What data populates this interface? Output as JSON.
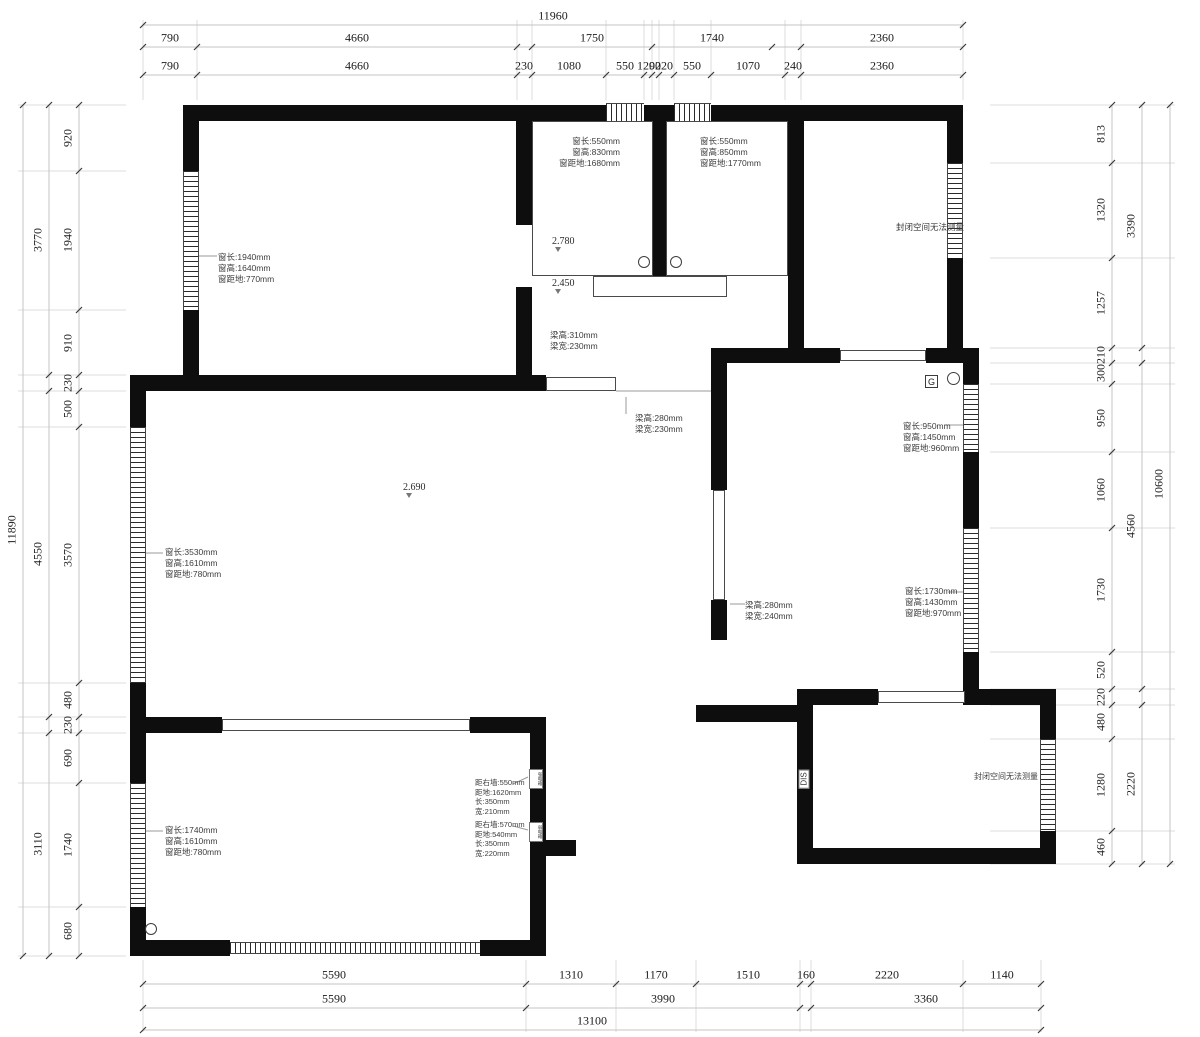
{
  "dims": {
    "top": {
      "total": [
        "11960"
      ],
      "row2": [
        "790",
        "4660",
        "1750",
        "1740",
        "2360"
      ],
      "row3": [
        "790",
        "4660",
        "230",
        "1080",
        "550",
        "120",
        "90",
        "220",
        "550",
        "1070",
        "240",
        "2360"
      ]
    },
    "bottom": {
      "row1": [
        "5590",
        "1310",
        "1170",
        "1510",
        "160",
        "2220",
        "1140"
      ],
      "row2": [
        "5590",
        "3990",
        "3360"
      ],
      "total": [
        "13100"
      ]
    },
    "left": {
      "inner": [
        "920",
        "1940",
        "910",
        "230",
        "500",
        "3570",
        "480",
        "230",
        "690",
        "1740",
        "680"
      ],
      "mid": [
        "3770",
        "4550",
        "3110"
      ],
      "total": [
        "11890"
      ]
    },
    "right": {
      "inner": [
        "813",
        "1320",
        "1257",
        "210",
        "300",
        "950",
        "1060",
        "1730",
        "520",
        "220",
        "480",
        "1280",
        "460"
      ],
      "mid": [
        "3390",
        "4560",
        "2220"
      ],
      "total": [
        "10600"
      ]
    }
  },
  "annotations": {
    "window_top_left_room": {
      "lines": [
        "窗长:1940mm",
        "窗高:1640mm",
        "窗距地:770mm"
      ]
    },
    "window_bath1": {
      "lines": [
        "窗长:550mm",
        "窗高:830mm",
        "窗距地:1680mm"
      ]
    },
    "window_bath2": {
      "lines": [
        "窗长:550mm",
        "窗高:850mm",
        "窗距地:1770mm"
      ]
    },
    "window_right_upper": {
      "lines": [
        "窗长:950mm",
        "窗高:1450mm",
        "窗距地:960mm"
      ]
    },
    "window_right_lower": {
      "lines": [
        "窗长:1730mm",
        "窗高:1430mm",
        "窗距地:970mm"
      ]
    },
    "window_living": {
      "lines": [
        "窗长:3530mm",
        "窗高:1610mm",
        "窗距地:780mm"
      ]
    },
    "window_bottom_left_room": {
      "lines": [
        "窗长:1740mm",
        "窗高:1610mm",
        "窗距地:780mm"
      ]
    },
    "beam1": {
      "lines": [
        "梁高:310mm",
        "梁宽:230mm"
      ]
    },
    "beam2": {
      "lines": [
        "梁高:280mm",
        "梁宽:230mm"
      ]
    },
    "beam3": {
      "lines": [
        "梁高:280mm",
        "梁宽:240mm"
      ]
    },
    "elec_box_high": {
      "lines": [
        "距右墙:550mm",
        "距地:1620mm",
        "长:350mm",
        "宽:210mm"
      ]
    },
    "elec_box_low": {
      "lines": [
        "距右墙:570mm",
        "距地:540mm",
        "长:350mm",
        "宽:220mm"
      ]
    },
    "elec_box_high_tag": "强电箱",
    "elec_box_low_tag": "弱电箱",
    "elevation_bath1_a": "2.780",
    "elevation_bath1_b": "2.450",
    "elevation_living": "2.690",
    "closed_space_top": "封闭空间无法测量",
    "closed_space_bottom": "封闭空间无法测量",
    "marker_g": "G",
    "marker_dis": "DIS"
  },
  "colors": {
    "wall": "#0e0e0e",
    "dim_line": "#c4c4c4",
    "tick": "#3a3a3a",
    "extension_line": "#dcdcdc",
    "dim_text": "#1c1c1c",
    "annotation_text": "#3d3d3d"
  }
}
